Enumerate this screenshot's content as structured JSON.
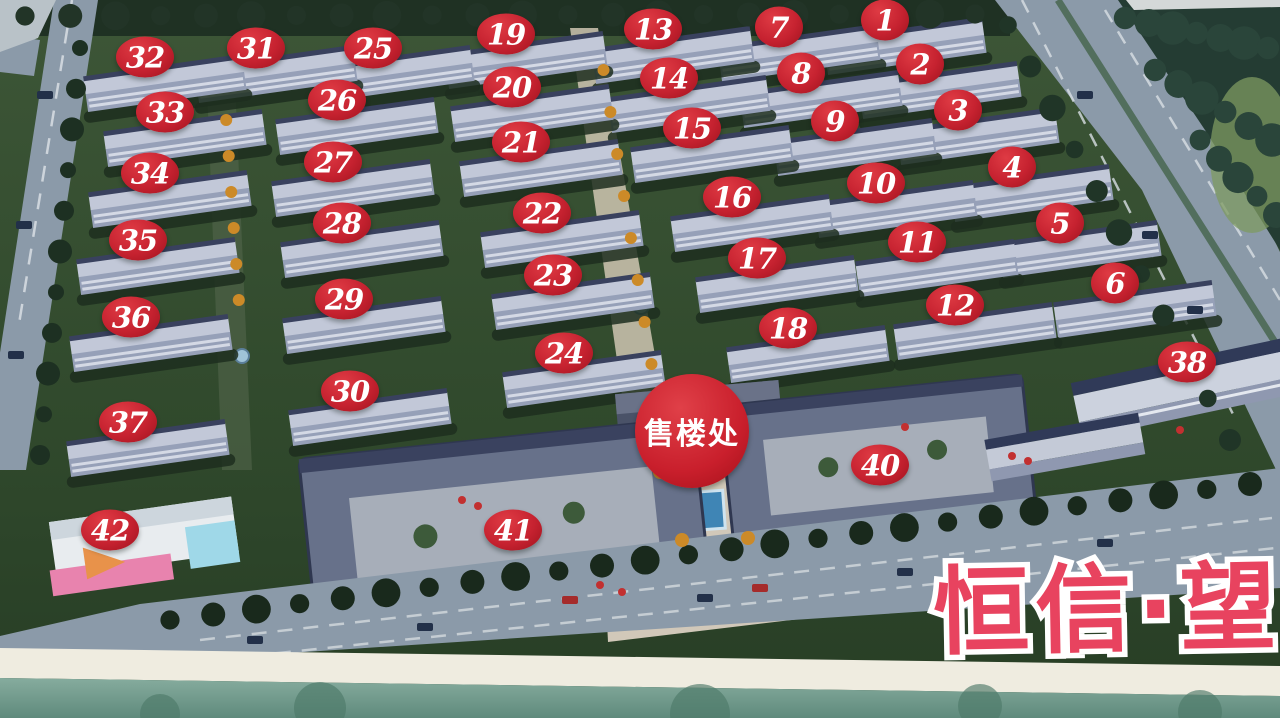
{
  "title": {
    "text": "恒信·望"
  },
  "sales_office": {
    "label": "售楼处",
    "x": 692,
    "y": 431,
    "diameter": 114
  },
  "badges": [
    {
      "n": "1",
      "x": 885,
      "y": 20
    },
    {
      "n": "2",
      "x": 920,
      "y": 64
    },
    {
      "n": "3",
      "x": 958,
      "y": 110
    },
    {
      "n": "4",
      "x": 1012,
      "y": 167
    },
    {
      "n": "5",
      "x": 1060,
      "y": 223
    },
    {
      "n": "6",
      "x": 1115,
      "y": 283
    },
    {
      "n": "7",
      "x": 779,
      "y": 27
    },
    {
      "n": "8",
      "x": 801,
      "y": 73
    },
    {
      "n": "9",
      "x": 835,
      "y": 121
    },
    {
      "n": "10",
      "x": 876,
      "y": 183
    },
    {
      "n": "11",
      "x": 917,
      "y": 242
    },
    {
      "n": "12",
      "x": 955,
      "y": 305
    },
    {
      "n": "13",
      "x": 653,
      "y": 29
    },
    {
      "n": "14",
      "x": 669,
      "y": 78
    },
    {
      "n": "15",
      "x": 692,
      "y": 128
    },
    {
      "n": "16",
      "x": 732,
      "y": 197
    },
    {
      "n": "17",
      "x": 757,
      "y": 258
    },
    {
      "n": "18",
      "x": 788,
      "y": 328
    },
    {
      "n": "19",
      "x": 506,
      "y": 34
    },
    {
      "n": "20",
      "x": 512,
      "y": 87
    },
    {
      "n": "21",
      "x": 521,
      "y": 142
    },
    {
      "n": "22",
      "x": 542,
      "y": 213
    },
    {
      "n": "23",
      "x": 553,
      "y": 275
    },
    {
      "n": "24",
      "x": 564,
      "y": 353
    },
    {
      "n": "25",
      "x": 373,
      "y": 48
    },
    {
      "n": "26",
      "x": 337,
      "y": 100
    },
    {
      "n": "27",
      "x": 333,
      "y": 162
    },
    {
      "n": "28",
      "x": 342,
      "y": 223
    },
    {
      "n": "29",
      "x": 344,
      "y": 299
    },
    {
      "n": "30",
      "x": 350,
      "y": 391
    },
    {
      "n": "31",
      "x": 256,
      "y": 48
    },
    {
      "n": "32",
      "x": 145,
      "y": 57
    },
    {
      "n": "33",
      "x": 165,
      "y": 112
    },
    {
      "n": "34",
      "x": 150,
      "y": 173
    },
    {
      "n": "35",
      "x": 138,
      "y": 240
    },
    {
      "n": "36",
      "x": 131,
      "y": 317
    },
    {
      "n": "37",
      "x": 128,
      "y": 422
    },
    {
      "n": "38",
      "x": 1187,
      "y": 362
    },
    {
      "n": "40",
      "x": 880,
      "y": 465
    },
    {
      "n": "41",
      "x": 513,
      "y": 530
    },
    {
      "n": "42",
      "x": 110,
      "y": 530
    }
  ],
  "colors": {
    "badge_red": "#c62230",
    "badge_text": "#ffffff",
    "title_pink": "#e8435f",
    "title_outline": "#ffffff",
    "lawn_green": "#33502f",
    "road_gray": "#8b9aa9",
    "roof_light": "#c2c8d8",
    "roof_ridge": "#39415e",
    "pool_blue": "#3f85b5"
  }
}
